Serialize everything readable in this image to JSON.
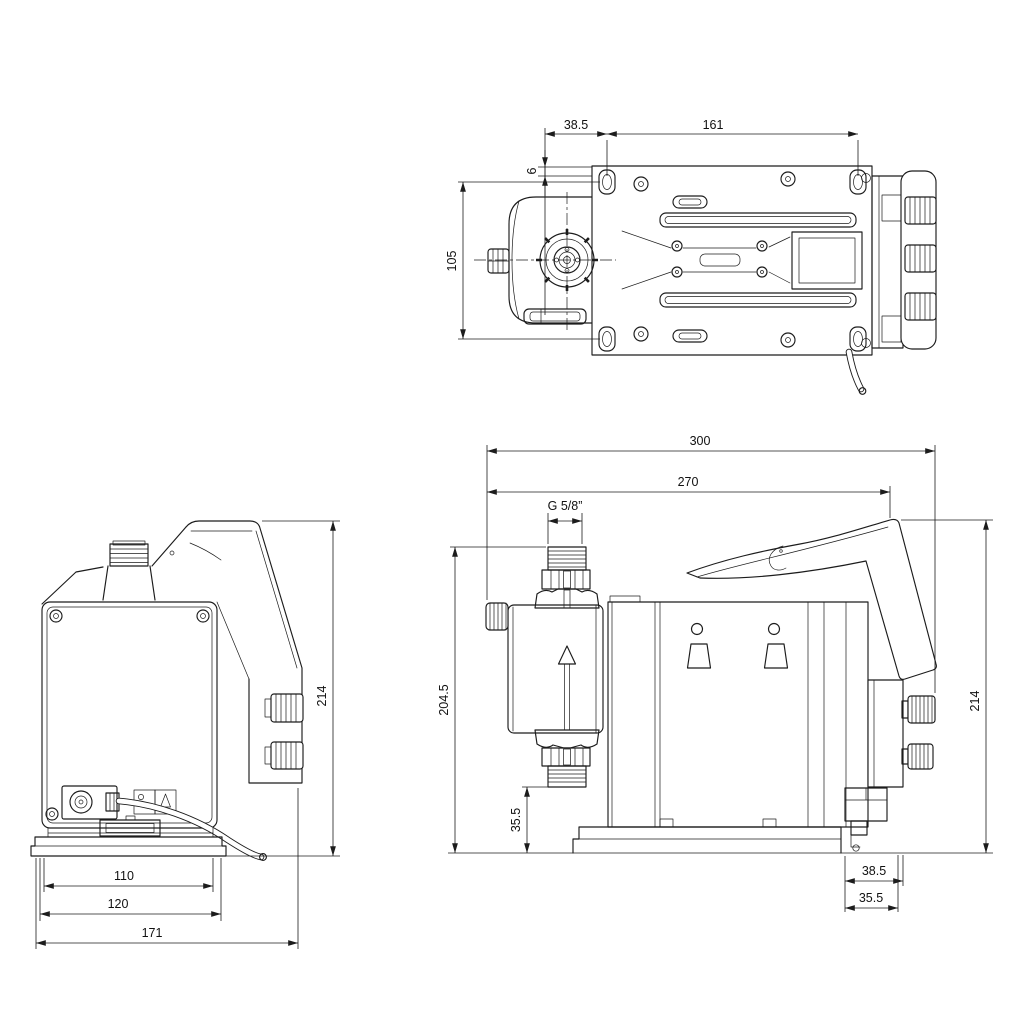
{
  "drawing": {
    "background": "#ffffff",
    "line_color": "#1c1c1c",
    "views": {
      "top": {
        "dims": {
          "offset_hole": "38.5",
          "hole_spacing": "161",
          "edge_offset": "6",
          "plate_width": "105"
        }
      },
      "back": {
        "dims": {
          "height": "214",
          "body_width": "110",
          "base_width": "120",
          "overall_depth": "171"
        }
      },
      "side": {
        "dims": {
          "overall_length": "300",
          "length_to_panel": "270",
          "thread": "G 5/8”",
          "suction_height": "204.5",
          "suction_clearance": "35.5",
          "panel_height": "214",
          "rear_offset_a": "38.5",
          "rear_offset_b": "35.5"
        }
      }
    }
  }
}
